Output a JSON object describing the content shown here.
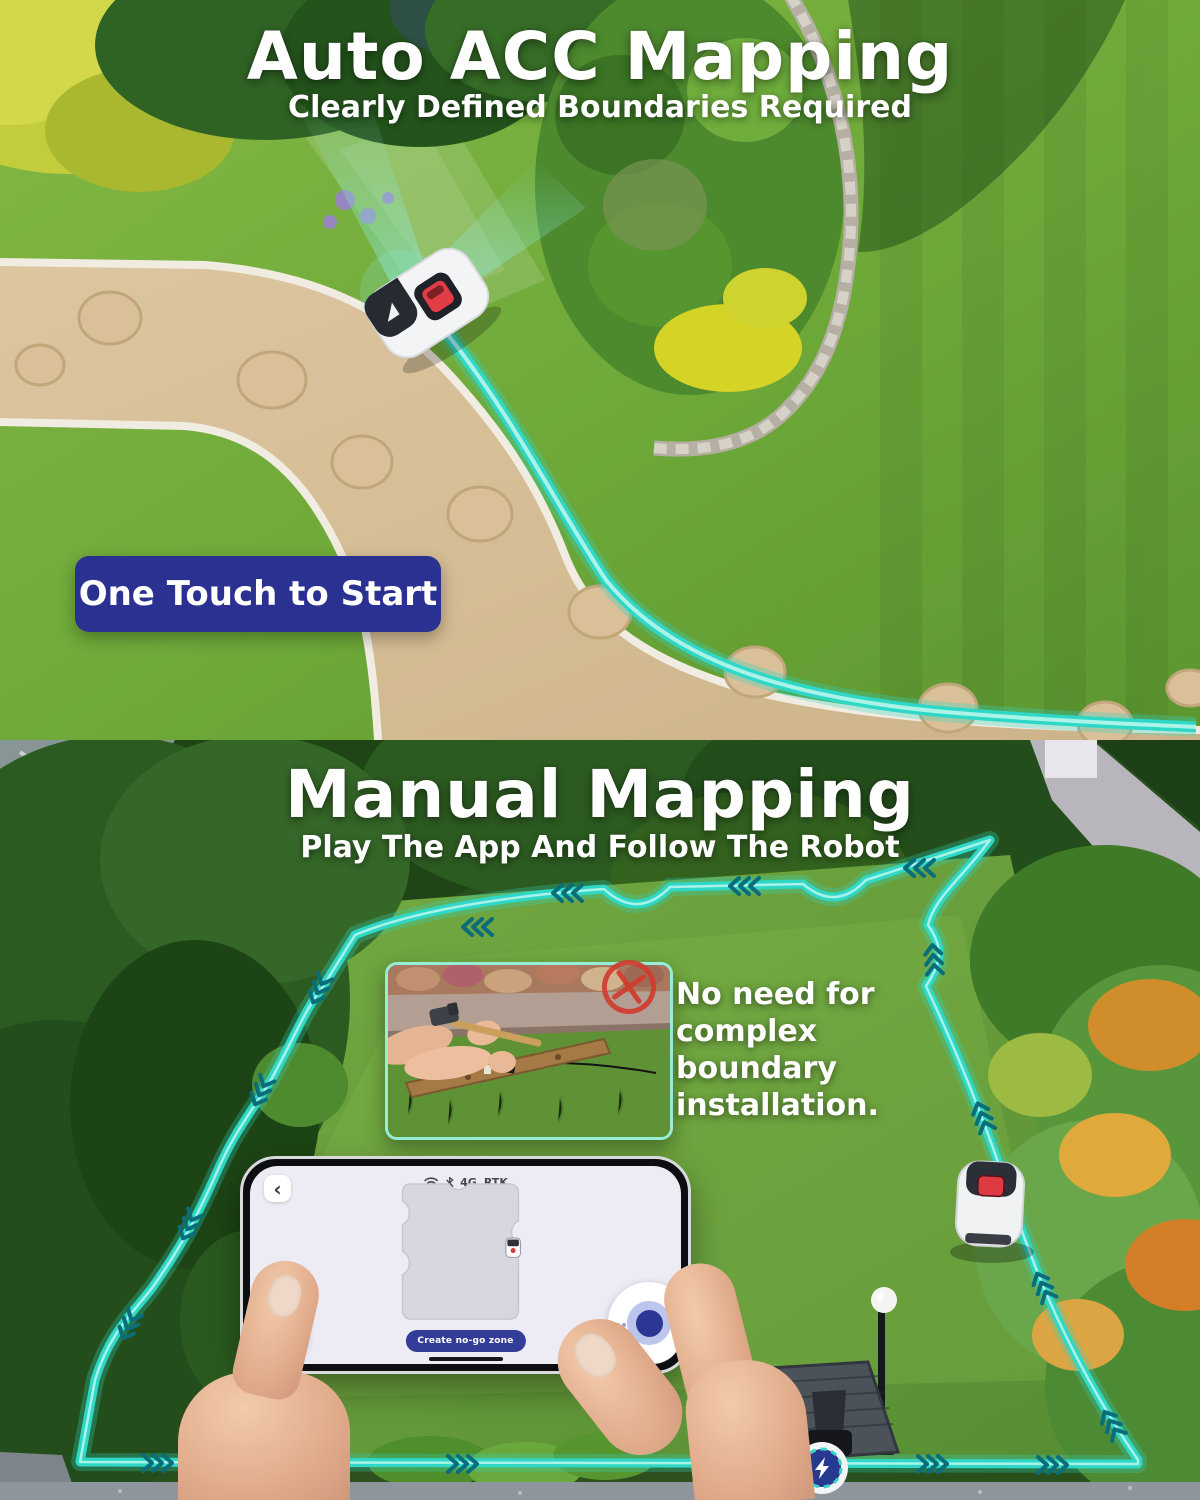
{
  "page": {
    "width": 1200,
    "height": 1500
  },
  "colors": {
    "teal": "#2fd8c6",
    "chevron_teal": "#0a6d7a",
    "navy": "#2b3190",
    "alert_red": "#d23b2f"
  },
  "auto_section": {
    "title": "Auto ACC Mapping",
    "subtitle": "Clearly Defined Boundaries Required",
    "start_banner": "One Touch to Start"
  },
  "manual_section": {
    "title": "Manual Mapping",
    "subtitle": "Play The App And Follow The Robot",
    "callout": "No need for complex boundary installation.",
    "phone": {
      "back_glyph": "‹",
      "status": {
        "network": "4G",
        "positioning": "RTK"
      },
      "map_button": "Create no-go zone"
    }
  }
}
